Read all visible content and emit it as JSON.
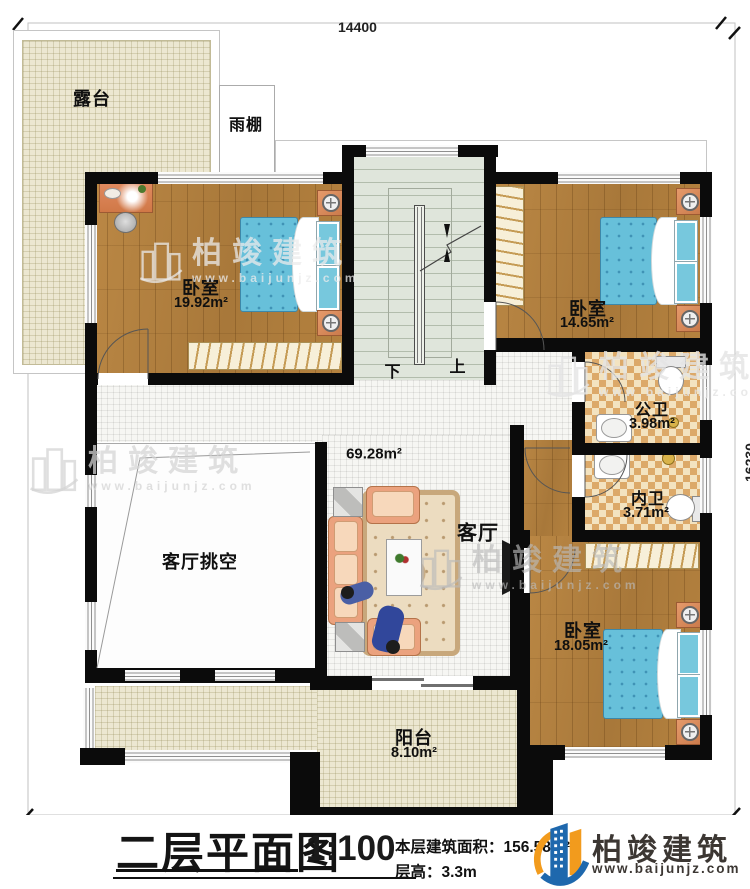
{
  "plan": {
    "dimensions": {
      "top": "14400",
      "right": "16230"
    },
    "rooms": {
      "terrace": {
        "name": "露台"
      },
      "canopy": {
        "name": "雨棚"
      },
      "bedroom1": {
        "name": "卧室",
        "area": "19.92m²"
      },
      "bedroom2": {
        "name": "卧室",
        "area": "14.65m²"
      },
      "public_bath": {
        "name": "公卫",
        "area": "3.98m²"
      },
      "ensuite_bath": {
        "name": "内卫",
        "area": "3.71m²"
      },
      "bedroom3": {
        "name": "卧室",
        "area": "18.05m²"
      },
      "living": {
        "name": "客厅",
        "area": "69.28m²"
      },
      "living_void": {
        "name": "客厅挑空"
      },
      "balcony": {
        "name": "阳台",
        "area": "8.10m²"
      }
    },
    "stairs": {
      "down": "下",
      "up": "上"
    }
  },
  "watermark": {
    "brand": "柏竣建筑",
    "url": "www.baijunjz.com"
  },
  "titleblock": {
    "title": "二层平面图",
    "scale": "1:100",
    "area_line": "本层建筑面积：156.58m²",
    "height_line": "层高：3.3m",
    "brand": "柏竣建筑",
    "brand_url": "www.baijunjz.com"
  },
  "colors": {
    "wall": "#0b0b0b",
    "wood_floor": "#b0803e",
    "bed_blue": "#67c0da",
    "terrace_beige": "#ece7d1",
    "checker_tile": "#dca969",
    "stair_green": "#dfe5db",
    "sofa_peach": "#eba27e",
    "logo_blue": "#1e68ad",
    "logo_orange": "#f29b1d"
  }
}
